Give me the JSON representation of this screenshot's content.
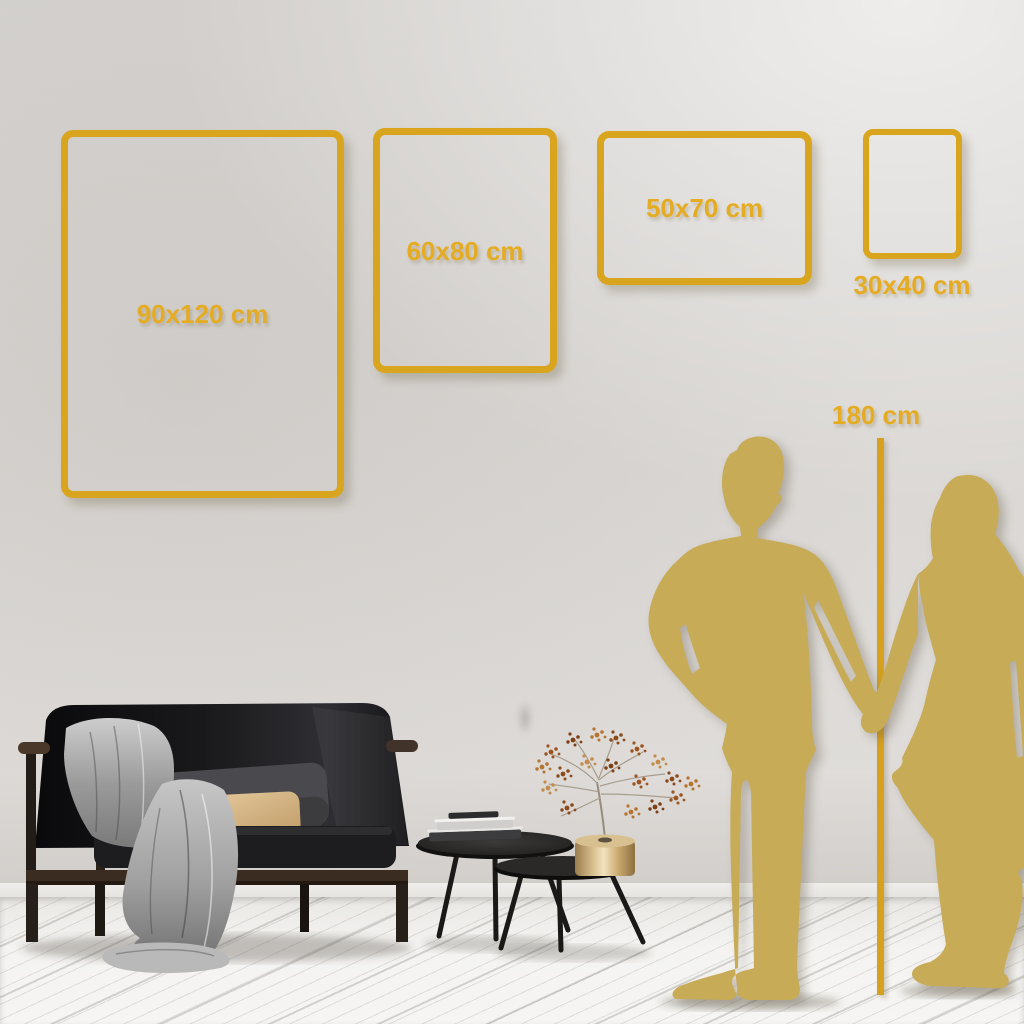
{
  "meta": {
    "description": "Wall-art poster size guide with room scene"
  },
  "palette": {
    "gold_frame": "#D9A51E",
    "gold_text": "#E5AC23",
    "silhouette_gold": "#C7AB57",
    "marker_line": "#D5A11E"
  },
  "frames": [
    {
      "id": "frame-90x120",
      "label": "90x120 cm",
      "width_cm": 90,
      "height_cm": 120
    },
    {
      "id": "frame-60x80",
      "label": "60x80 cm",
      "width_cm": 60,
      "height_cm": 80
    },
    {
      "id": "frame-50x70",
      "label": "50x70 cm",
      "width_cm": 50,
      "height_cm": 70
    },
    {
      "id": "frame-30x40",
      "label": "30x40 cm",
      "width_cm": 30,
      "height_cm": 40
    }
  ],
  "height_marker": {
    "label": "180 cm",
    "height_cm": 180
  },
  "scene_icons": [
    "man-silhouette",
    "woman-silhouette",
    "sofa",
    "throw-blanket",
    "back-cushion",
    "lumbar-pillow",
    "nesting-coffee-tables",
    "book-stack",
    "brass-vase",
    "dried-flowers"
  ]
}
